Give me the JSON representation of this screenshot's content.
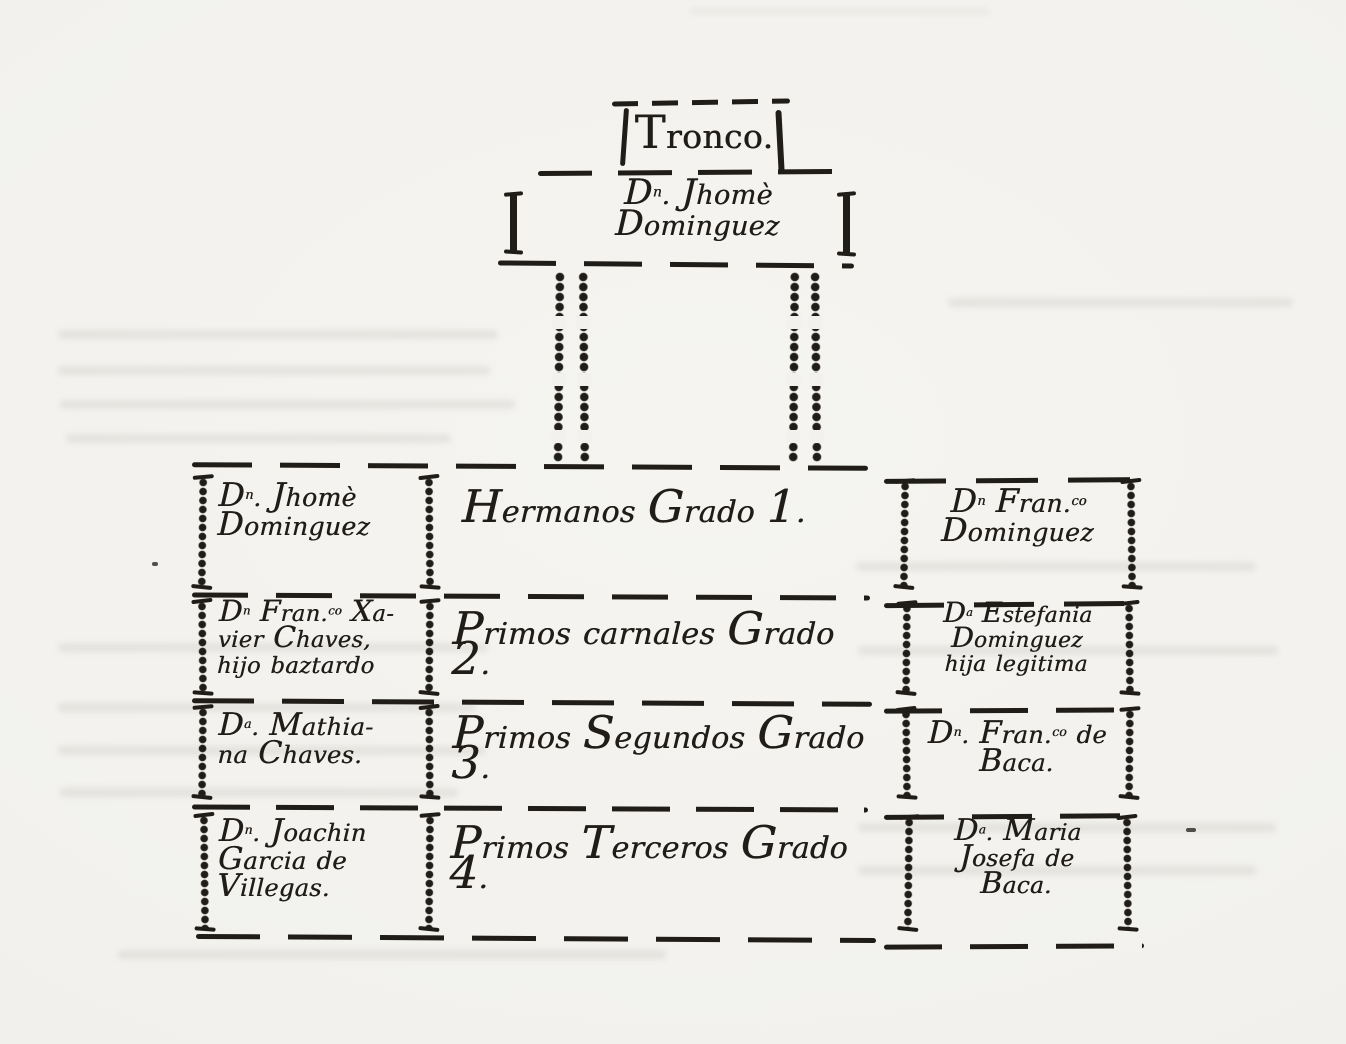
{
  "figure": {
    "kind": "genealogical consanguinity chart (hand-drawn, scanned book page)",
    "ink_color": "#201d19",
    "paper_color": "#f2f1ed",
    "tronco_label": "Tronco.",
    "root": {
      "lines": [
        "D^n^. Jhomè",
        "Dominguez"
      ]
    },
    "rows": [
      {
        "left": [
          "D^n^. Jhomè",
          "Dominguez"
        ],
        "center": "Hermanos Grado 1.",
        "right": [
          "D^n^ Fran.^co^",
          "Dominguez"
        ]
      },
      {
        "left": [
          "D^n^ Fran.^co^ Xa-",
          "vier Chaves,",
          "hijo baztardo"
        ],
        "center": "Primos carnales Grado 2.",
        "right": [
          "D^a^ Estefania",
          "Dominguez",
          "hija legitima"
        ]
      },
      {
        "left": [
          "D^a^. Mathia-",
          "na Chaves."
        ],
        "center": "Primos Segundos Grado 3.",
        "right": [
          "D^n^. Fran.^co^ de",
          "Baca."
        ]
      },
      {
        "left": [
          "D^n^. Joachin",
          "Garcia de",
          "Villegas."
        ],
        "center": "Primos Terceros Grado 4.",
        "right": [
          "D^a^. Maria",
          "Josefa de",
          "Baca."
        ]
      }
    ]
  }
}
